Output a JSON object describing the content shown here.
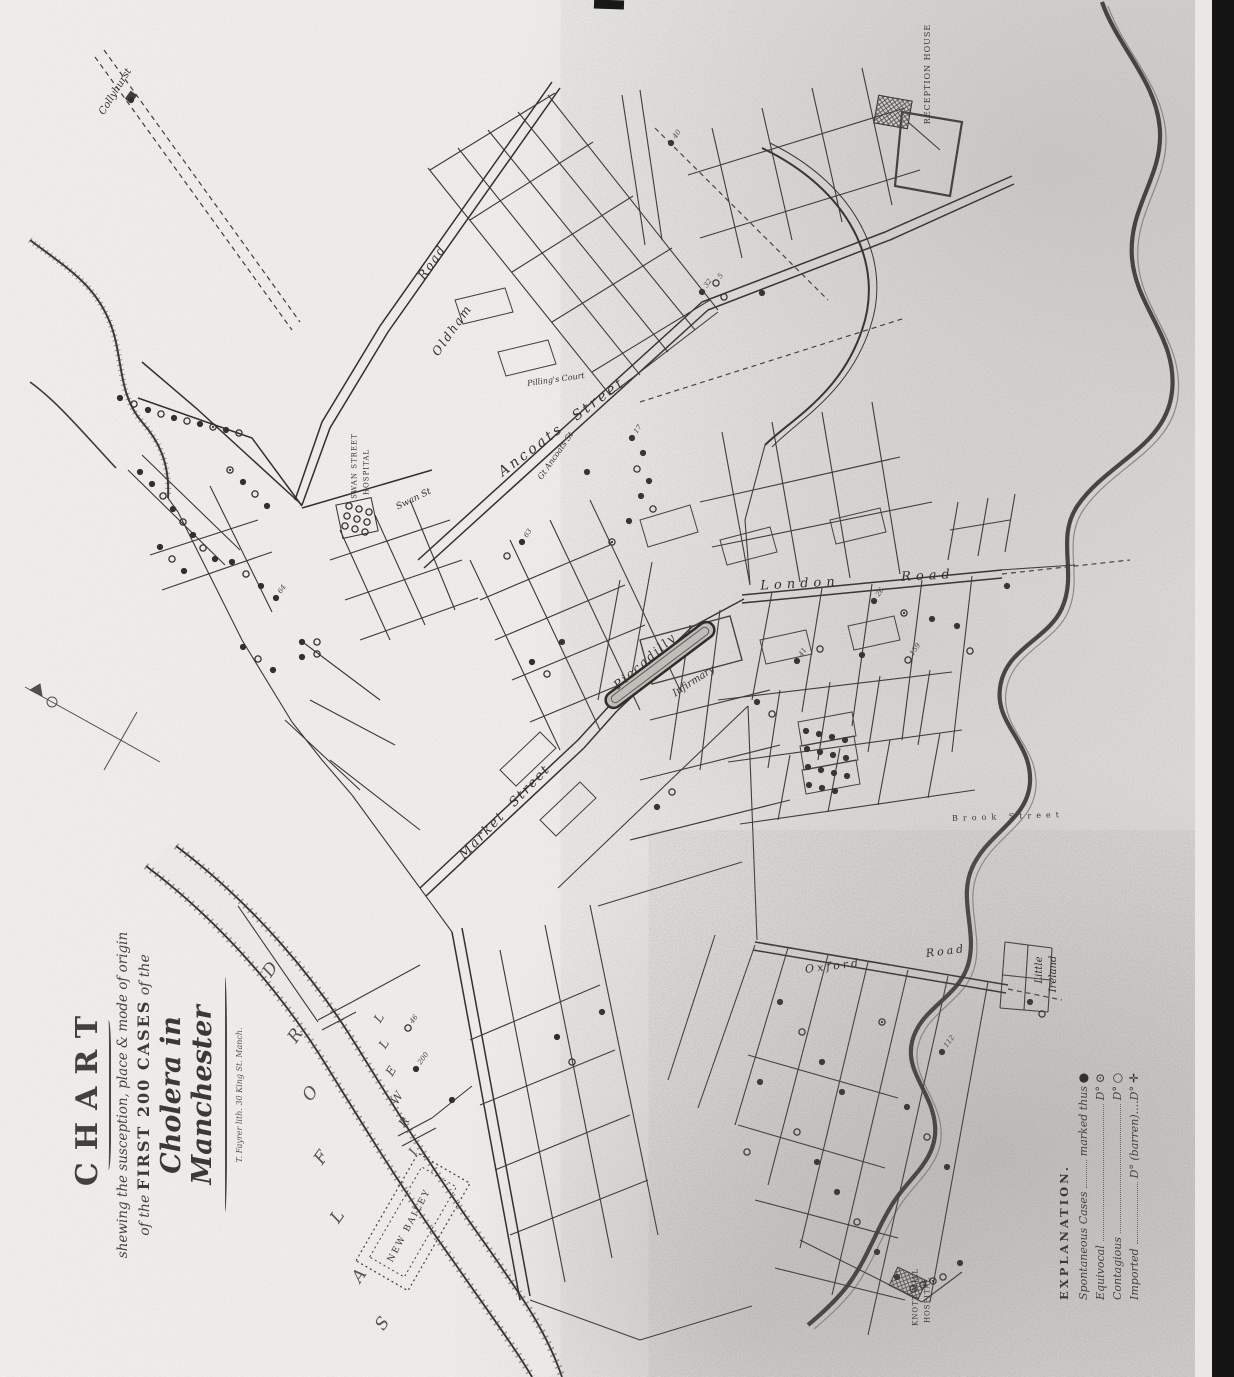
{
  "title_block": {
    "heading": "CHART",
    "line2": "shewing the susception, place & mode of origin",
    "line3_prefix": "of the",
    "line3_caps": "FIRST 200 CASES",
    "line3_suffix": "of the",
    "line4": "Cholera in Manchester",
    "credit": "T. Fayrer lith. 30 King St. Manch."
  },
  "legend": {
    "heading": "EXPLANATION.",
    "rows": [
      {
        "label": "Spontaneous Cases",
        "value": "marked thus",
        "symbol_glyph": "●",
        "symbol": "solid-circle"
      },
      {
        "label": "Equivocal",
        "value": "D°",
        "symbol_glyph": "⊙",
        "symbol": "dotted-circle"
      },
      {
        "label": "Contagious",
        "value": "D°",
        "symbol_glyph": "○",
        "symbol": "open-circle"
      },
      {
        "label": "Imported",
        "value": "D° (barren)....D°",
        "symbol_glyph": "✛",
        "symbol": "cross"
      }
    ]
  },
  "map": {
    "labels": [
      {
        "text": "Collyhurst",
        "x": 116,
        "y": 92,
        "rot": -58,
        "cls": "script",
        "size": 10
      },
      {
        "text": "Road",
        "x": 432,
        "y": 262,
        "rot": -55,
        "cls": "script",
        "size": 12,
        "ls": 2
      },
      {
        "text": "Oldham",
        "x": 452,
        "y": 330,
        "rot": -55,
        "cls": "script",
        "size": 12,
        "ls": 2
      },
      {
        "text": "Ancoats  Street",
        "x": 562,
        "y": 427,
        "rot": -37,
        "cls": "script",
        "size": 14,
        "ls": 3
      },
      {
        "text": "Gt Ancoats St",
        "x": 556,
        "y": 456,
        "rot": -55,
        "cls": "script",
        "size": 8
      },
      {
        "text": "Swan St",
        "x": 414,
        "y": 500,
        "rot": -26,
        "cls": "script",
        "size": 9
      },
      {
        "text": "SWAN STREET",
        "x": 355,
        "y": 466,
        "rot": -90,
        "cls": "caps",
        "size": 7
      },
      {
        "text": "HOSPITAL",
        "x": 367,
        "y": 472,
        "rot": -90,
        "cls": "caps",
        "size": 7
      },
      {
        "text": "Pilling's Court",
        "x": 556,
        "y": 380,
        "rot": -8,
        "cls": "script",
        "size": 8
      },
      {
        "text": "London",
        "x": 800,
        "y": 584,
        "rot": -3,
        "cls": "script",
        "size": 13,
        "ls": 5
      },
      {
        "text": "Road",
        "x": 928,
        "y": 576,
        "rot": -3,
        "cls": "script",
        "size": 13,
        "ls": 5
      },
      {
        "text": "Piccadilly",
        "x": 645,
        "y": 661,
        "rot": -41,
        "cls": "script",
        "size": 12,
        "ls": 2
      },
      {
        "text": "Infirmary",
        "x": 694,
        "y": 682,
        "rot": -33,
        "cls": "script",
        "size": 10
      },
      {
        "text": "Market  Street",
        "x": 505,
        "y": 812,
        "rot": -46,
        "cls": "script",
        "size": 13,
        "ls": 2
      },
      {
        "text": "Oxford",
        "x": 833,
        "y": 966,
        "rot": -7,
        "cls": "script",
        "size": 11,
        "ls": 3
      },
      {
        "text": "Road",
        "x": 946,
        "y": 951,
        "rot": -7,
        "cls": "script",
        "size": 11,
        "ls": 3
      },
      {
        "text": "Brook Street",
        "x": 1008,
        "y": 817,
        "rot": -2,
        "cls": "caps",
        "size": 8,
        "ls": 5
      },
      {
        "text": "Little",
        "x": 1040,
        "y": 970,
        "rot": -90,
        "cls": "script",
        "size": 10
      },
      {
        "text": "Ireland",
        "x": 1054,
        "y": 974,
        "rot": -90,
        "cls": "script",
        "size": 10
      },
      {
        "text": "NEW BAILEY",
        "x": 410,
        "y": 1226,
        "rot": -62,
        "cls": "caps",
        "size": 9,
        "ls": 2
      },
      {
        "text": "RECEPTION HOUSE",
        "x": 928,
        "y": 74,
        "rot": -90,
        "cls": "caps",
        "size": 8,
        "ls": 1
      },
      {
        "text": "KNOTT MILL",
        "x": 916,
        "y": 1297,
        "rot": -90,
        "cls": "caps",
        "size": 7
      },
      {
        "text": "HOSPITAL",
        "x": 928,
        "y": 1300,
        "rot": -90,
        "cls": "caps",
        "size": 7
      },
      {
        "text": "I",
        "x": 413,
        "y": 1152,
        "rot": -58,
        "cls": "river",
        "size": 12
      },
      {
        "text": "R",
        "x": 404,
        "y": 1122,
        "rot": -58,
        "cls": "river",
        "size": 12
      },
      {
        "text": "W",
        "x": 397,
        "y": 1098,
        "rot": -58,
        "cls": "river",
        "size": 12
      },
      {
        "text": "E",
        "x": 391,
        "y": 1071,
        "rot": -58,
        "cls": "river",
        "size": 12
      },
      {
        "text": "L",
        "x": 384,
        "y": 1044,
        "rot": -58,
        "cls": "river",
        "size": 12
      },
      {
        "text": "L",
        "x": 379,
        "y": 1018,
        "rot": -58,
        "cls": "river",
        "size": 12
      },
      {
        "text": "S",
        "x": 383,
        "y": 1324,
        "rot": -55,
        "cls": "bigletter",
        "size": 17
      },
      {
        "text": "A",
        "x": 360,
        "y": 1276,
        "rot": -55,
        "cls": "bigletter",
        "size": 17
      },
      {
        "text": "L",
        "x": 338,
        "y": 1217,
        "rot": -55,
        "cls": "bigletter",
        "size": 17
      },
      {
        "text": "F",
        "x": 322,
        "y": 1158,
        "rot": -55,
        "cls": "bigletter",
        "size": 17
      },
      {
        "text": "O",
        "x": 311,
        "y": 1094,
        "rot": -55,
        "cls": "bigletter",
        "size": 17
      },
      {
        "text": "R",
        "x": 296,
        "y": 1036,
        "rot": -55,
        "cls": "bigletter",
        "size": 17
      },
      {
        "text": "D",
        "x": 271,
        "y": 970,
        "rot": -55,
        "cls": "bigletter",
        "size": 17
      }
    ],
    "case_dots": [
      [
        148,
        410,
        "s"
      ],
      [
        161,
        414,
        "o"
      ],
      [
        174,
        418,
        "s"
      ],
      [
        187,
        421,
        "o"
      ],
      [
        200,
        424,
        "s"
      ],
      [
        213,
        427,
        "d"
      ],
      [
        226,
        430,
        "s"
      ],
      [
        239,
        433,
        "o"
      ],
      [
        120,
        398,
        "s"
      ],
      [
        134,
        404,
        "o"
      ],
      [
        140,
        472,
        "s"
      ],
      [
        152,
        484,
        "s"
      ],
      [
        163,
        496,
        "o"
      ],
      [
        173,
        509,
        "s"
      ],
      [
        183,
        522,
        "o"
      ],
      [
        193,
        535,
        "s"
      ],
      [
        203,
        548,
        "o"
      ],
      [
        215,
        559,
        "s"
      ],
      [
        230,
        470,
        "d"
      ],
      [
        243,
        482,
        "s"
      ],
      [
        255,
        494,
        "o"
      ],
      [
        267,
        506,
        "s"
      ],
      [
        160,
        547,
        "s"
      ],
      [
        172,
        559,
        "o"
      ],
      [
        184,
        571,
        "s"
      ],
      [
        232,
        562,
        "s"
      ],
      [
        246,
        574,
        "o"
      ],
      [
        261,
        586,
        "s"
      ],
      [
        276,
        598,
        "s",
        "64"
      ],
      [
        243,
        647,
        "s"
      ],
      [
        258,
        659,
        "o"
      ],
      [
        273,
        670,
        "s"
      ],
      [
        302,
        642,
        "s"
      ],
      [
        317,
        654,
        "o"
      ],
      [
        349,
        506,
        "o"
      ],
      [
        359,
        509,
        "o"
      ],
      [
        369,
        512,
        "o"
      ],
      [
        347,
        516,
        "o"
      ],
      [
        357,
        519,
        "o"
      ],
      [
        367,
        522,
        "o"
      ],
      [
        345,
        526,
        "o"
      ],
      [
        355,
        529,
        "o"
      ],
      [
        365,
        532,
        "o"
      ],
      [
        632,
        438,
        "s",
        "17"
      ],
      [
        643,
        453,
        "s"
      ],
      [
        637,
        469,
        "o"
      ],
      [
        649,
        481,
        "s"
      ],
      [
        641,
        496,
        "s"
      ],
      [
        653,
        509,
        "o"
      ],
      [
        629,
        521,
        "s"
      ],
      [
        702,
        292,
        "s",
        "32"
      ],
      [
        724,
        297,
        "o"
      ],
      [
        671,
        143,
        "s",
        "40"
      ],
      [
        762,
        293,
        "s"
      ],
      [
        716,
        283,
        "o",
        "5"
      ],
      [
        522,
        542,
        "s",
        "63"
      ],
      [
        507,
        556,
        "o"
      ],
      [
        532,
        662,
        "s"
      ],
      [
        547,
        674,
        "o"
      ],
      [
        562,
        642,
        "s"
      ],
      [
        612,
        542,
        "d"
      ],
      [
        587,
        472,
        "s"
      ],
      [
        302,
        657,
        "s"
      ],
      [
        317,
        642,
        "o"
      ],
      [
        874,
        601,
        "s",
        "26"
      ],
      [
        904,
        613,
        "d"
      ],
      [
        932,
        619,
        "s"
      ],
      [
        957,
        626,
        "s"
      ],
      [
        970,
        651,
        "o"
      ],
      [
        1007,
        586,
        "s"
      ],
      [
        820,
        649,
        "o"
      ],
      [
        797,
        661,
        "s",
        "41"
      ],
      [
        862,
        655,
        "s"
      ],
      [
        908,
        660,
        "o",
        "159"
      ],
      [
        806,
        731,
        "s"
      ],
      [
        819,
        734,
        "s"
      ],
      [
        832,
        737,
        "s"
      ],
      [
        845,
        740,
        "s"
      ],
      [
        807,
        749,
        "s"
      ],
      [
        820,
        752,
        "s"
      ],
      [
        833,
        755,
        "s"
      ],
      [
        846,
        758,
        "s"
      ],
      [
        808,
        767,
        "s"
      ],
      [
        821,
        770,
        "s"
      ],
      [
        834,
        773,
        "s"
      ],
      [
        847,
        776,
        "s"
      ],
      [
        809,
        785,
        "s"
      ],
      [
        822,
        788,
        "s"
      ],
      [
        835,
        791,
        "s"
      ],
      [
        757,
        702,
        "s"
      ],
      [
        772,
        714,
        "o"
      ],
      [
        657,
        807,
        "s"
      ],
      [
        672,
        792,
        "o"
      ],
      [
        557,
        1037,
        "s"
      ],
      [
        572,
        1062,
        "o"
      ],
      [
        602,
        1012,
        "s"
      ],
      [
        408,
        1028,
        "o",
        "46"
      ],
      [
        416,
        1069,
        "s",
        "200"
      ],
      [
        452,
        1100,
        "s"
      ],
      [
        780,
        1002,
        "s"
      ],
      [
        802,
        1032,
        "o"
      ],
      [
        822,
        1062,
        "s"
      ],
      [
        842,
        1092,
        "s"
      ],
      [
        797,
        1132,
        "o"
      ],
      [
        817,
        1162,
        "s"
      ],
      [
        837,
        1192,
        "s"
      ],
      [
        857,
        1222,
        "o"
      ],
      [
        877,
        1252,
        "s"
      ],
      [
        897,
        1277,
        "s"
      ],
      [
        760,
        1082,
        "s"
      ],
      [
        747,
        1152,
        "o"
      ],
      [
        907,
        1107,
        "s"
      ],
      [
        927,
        1137,
        "o"
      ],
      [
        947,
        1167,
        "s"
      ],
      [
        882,
        1022,
        "d"
      ],
      [
        942,
        1052,
        "s",
        "112"
      ],
      [
        1030,
        1002,
        "s"
      ],
      [
        1042,
        1014,
        "o"
      ],
      [
        913,
        1289,
        "o"
      ],
      [
        923,
        1285,
        "o"
      ],
      [
        933,
        1281,
        "d"
      ],
      [
        943,
        1277,
        "o"
      ],
      [
        960,
        1263,
        "s"
      ],
      [
        131,
        100,
        "s"
      ]
    ]
  }
}
